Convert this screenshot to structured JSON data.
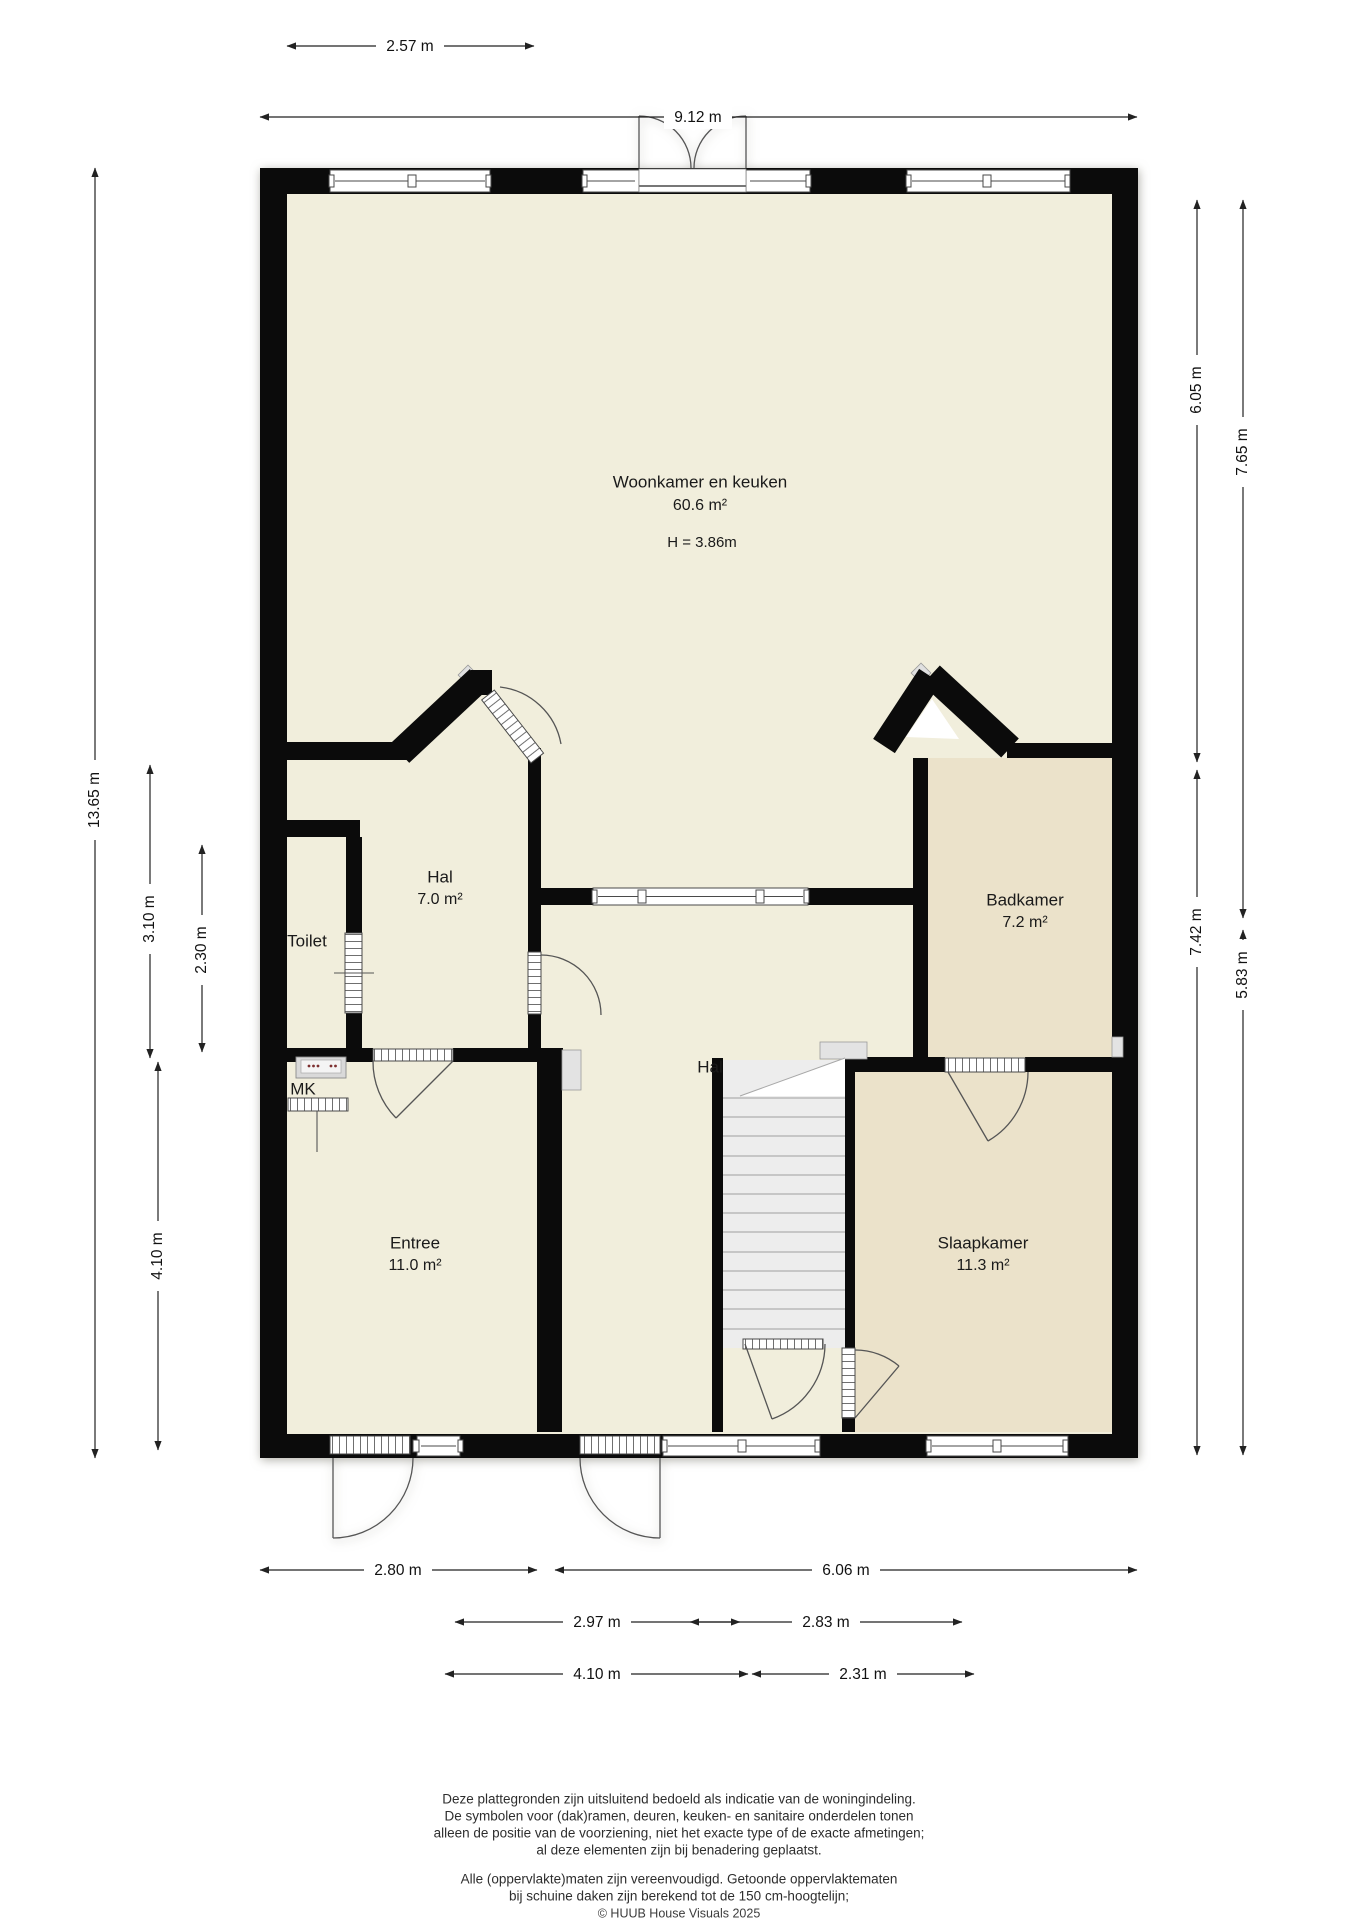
{
  "rooms": {
    "woonkamer": {
      "name": "Woonkamer en keuken",
      "area": "60.6 m²",
      "height": "H = 3.86m"
    },
    "hal_boven": {
      "name": "Hal",
      "area": "7.0 m²"
    },
    "toilet": {
      "name": "Toilet"
    },
    "mk": {
      "name": "MK"
    },
    "badkamer": {
      "name": "Badkamer",
      "area": "7.2 m²"
    },
    "hal_midden": {
      "name": "Hal"
    },
    "entree": {
      "name": "Entree",
      "area": "11.0 m²"
    },
    "slaapkamer": {
      "name": "Slaapkamer",
      "area": "11.3 m²"
    }
  },
  "dimensions": {
    "top": {
      "d1": "2.57 m",
      "d2": "9.12 m"
    },
    "left": {
      "d1": "13.65 m",
      "d2": "3.10 m",
      "d3": "2.30 m",
      "d4": "4.10 m"
    },
    "right": {
      "d1": "6.05 m",
      "d2": "7.65 m",
      "d3": "7.42 m",
      "d4": "5.83 m"
    },
    "bottom": {
      "d1": "2.80 m",
      "d2": "6.06 m",
      "d3": "2.97 m",
      "d4": "2.83 m",
      "d5": "4.10 m",
      "d6": "2.31 m"
    }
  },
  "footer": {
    "disclaimer1": [
      "Deze plattegronden zijn uitsluitend bedoeld als indicatie van de woningindeling.",
      "De symbolen voor (dak)ramen, deuren, keuken- en sanitaire onderdelen tonen",
      "alleen de positie van de voorziening, niet het exacte type of de exacte afmetingen;",
      "al deze elementen zijn bij benadering geplaatst."
    ],
    "disclaimer2": [
      "Alle (oppervlakte)maten zijn vereenvoudigd. Getoonde oppervlaktematen",
      "bij schuine daken zijn berekend tot de 150 cm-hoogtelijn;"
    ],
    "copyright": "© HUUB House Visuals 2025"
  },
  "colors": {
    "wall": "#0b0b0b",
    "floor_light": "#f1eedc",
    "floor_dark": "#ebe2ca",
    "stair": "#ededed",
    "background": "#ffffff"
  }
}
